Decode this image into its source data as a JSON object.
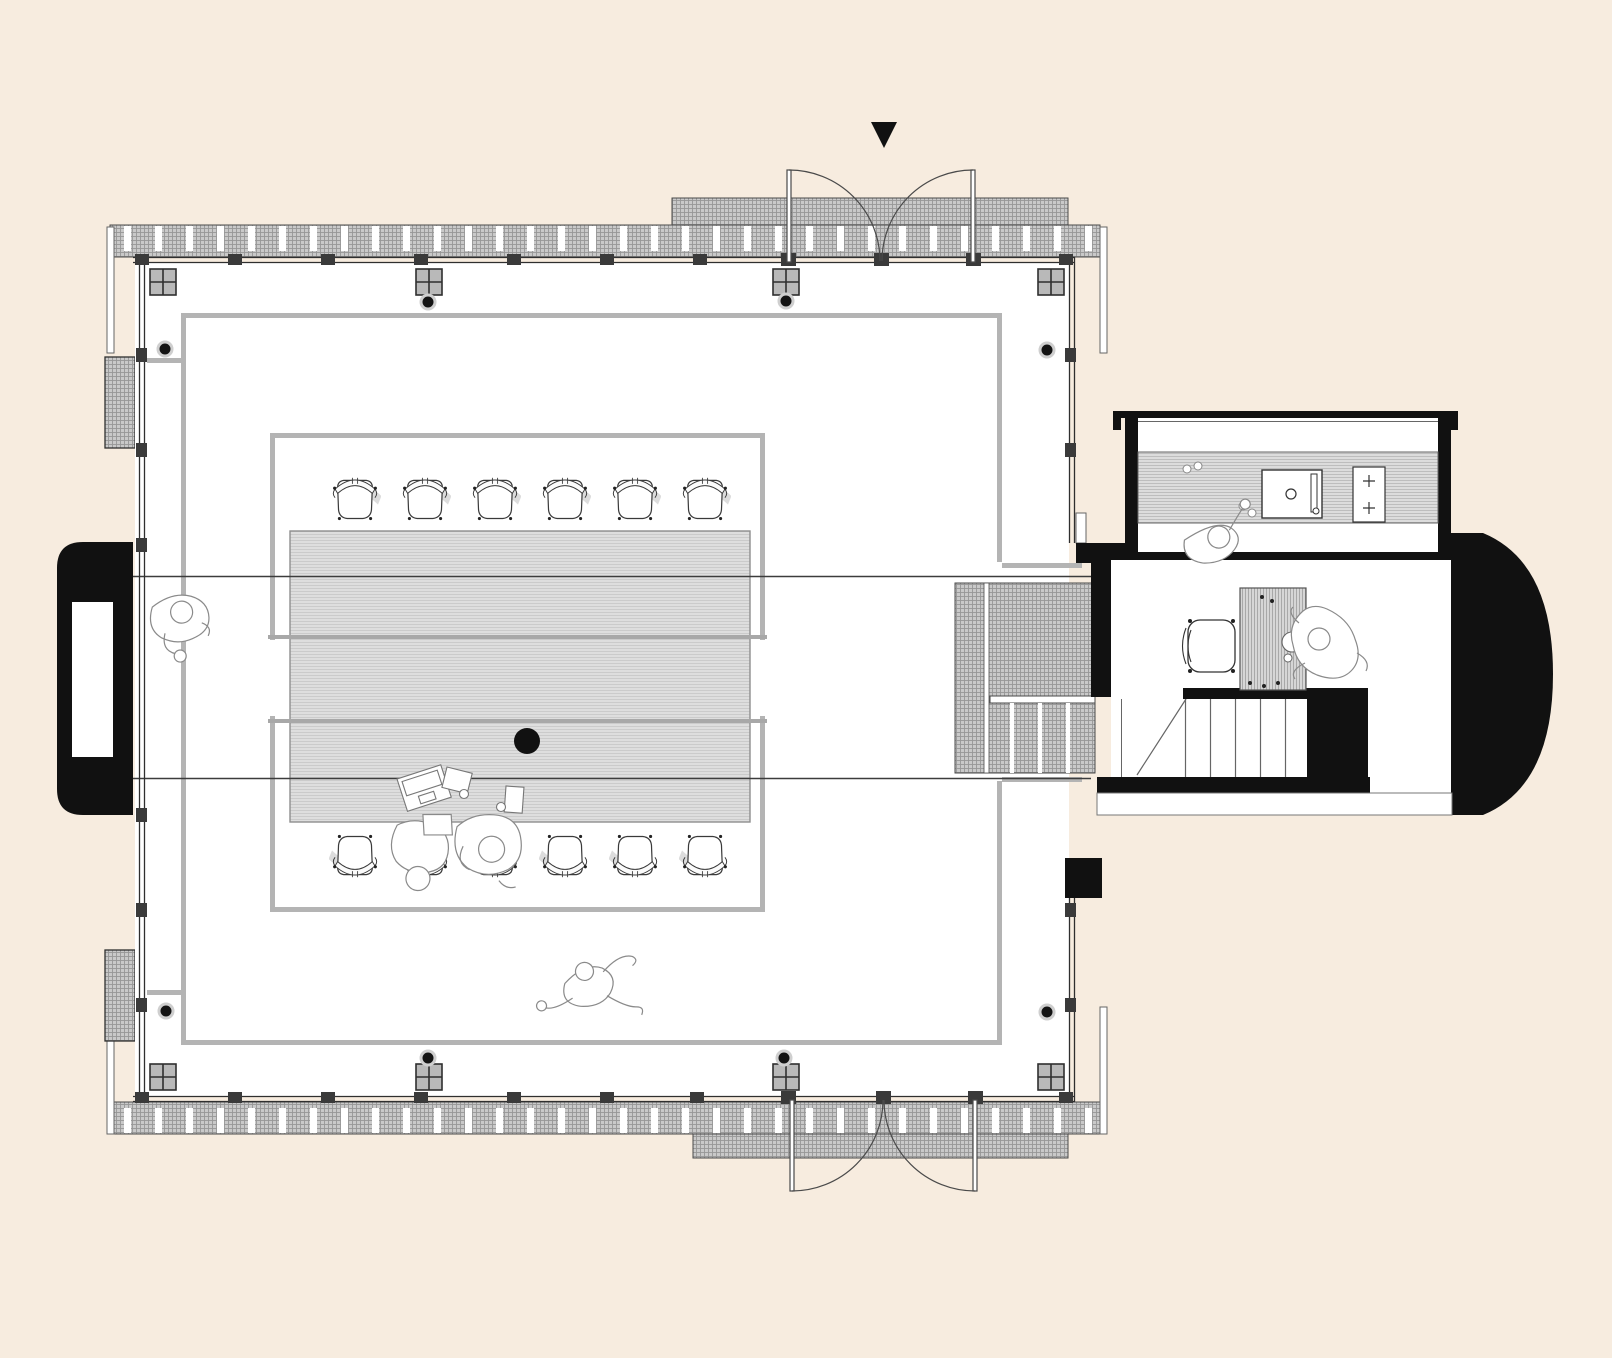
{
  "document": {
    "kind": "architectural floor plan",
    "view": "top-down plan drawing",
    "visible_text": "",
    "style": "minimal line drawing on cream background"
  },
  "colors": {
    "background": "#f7ecdf",
    "paper": "#ffffff",
    "black": "#111111",
    "ink": "#2f2f2f",
    "line": "#4a4a4a",
    "thin_line": "#666666",
    "structural_line": "#3c3c3c",
    "gray_boundary": "#b4b4b4",
    "hatch_base": "#c9c9c9",
    "hatch_line": "#979797",
    "table_base": "#dedede",
    "table_line": "#cbcbcb",
    "table_edge": "#8f8f8f",
    "counter_base": "#dcdcdc",
    "counter_line": "#bdbdbd",
    "desk_base": "#d6d6d6",
    "desk_line": "#a8a8a8",
    "square_fill": "#b9b9b9",
    "figure_line": "#8a8a8a",
    "shadow": "#dcdcdc"
  },
  "scene": {
    "entrance_marker": {
      "shape": "solid triangle",
      "position": "top center"
    },
    "double_doors": {
      "count": 2,
      "positions": [
        "north wall",
        "south wall"
      ],
      "leaves_per_door": 2
    },
    "deck_bands": {
      "count": 2,
      "texture": "cross-hatch with regular mullion slots",
      "pads": 2
    },
    "main_hall": {
      "table": {
        "planks": 3,
        "texture": "fine horizontal grain",
        "center_dot": true,
        "items_on_table": [
          "laptop",
          "paper",
          "paper",
          "cup",
          "cup"
        ]
      },
      "chairs_north_row": 6,
      "chairs_south_row": 6,
      "column_squares": 8,
      "column_dots": 8,
      "fireplace": {
        "position": "west wall",
        "shape": "rounded black alcove with white inset"
      },
      "wall_vents": 2
    },
    "connector": {
      "texture": "cross-hatched deck link",
      "dividers": 4
    },
    "annex": {
      "kitchen": {
        "counter": true,
        "sink": true,
        "cooktop_burners": 2,
        "small_items": 4
      },
      "office": {
        "desk": true,
        "office_chair": true
      },
      "stairs": {
        "tread_lines": 5,
        "diagonal_cut_line": true
      },
      "east_wall": "black D-shaped curved wall"
    },
    "people": [
      {
        "pose": "standing",
        "location": "west side of main hall"
      },
      {
        "pose": "seated holding paper",
        "location": "south table edge"
      },
      {
        "pose": "seated",
        "location": "south table edge"
      },
      {
        "pose": "walking",
        "location": "south of table"
      },
      {
        "pose": "standing at counter",
        "location": "kitchen"
      },
      {
        "pose": "seated at desk",
        "location": "office"
      }
    ]
  }
}
